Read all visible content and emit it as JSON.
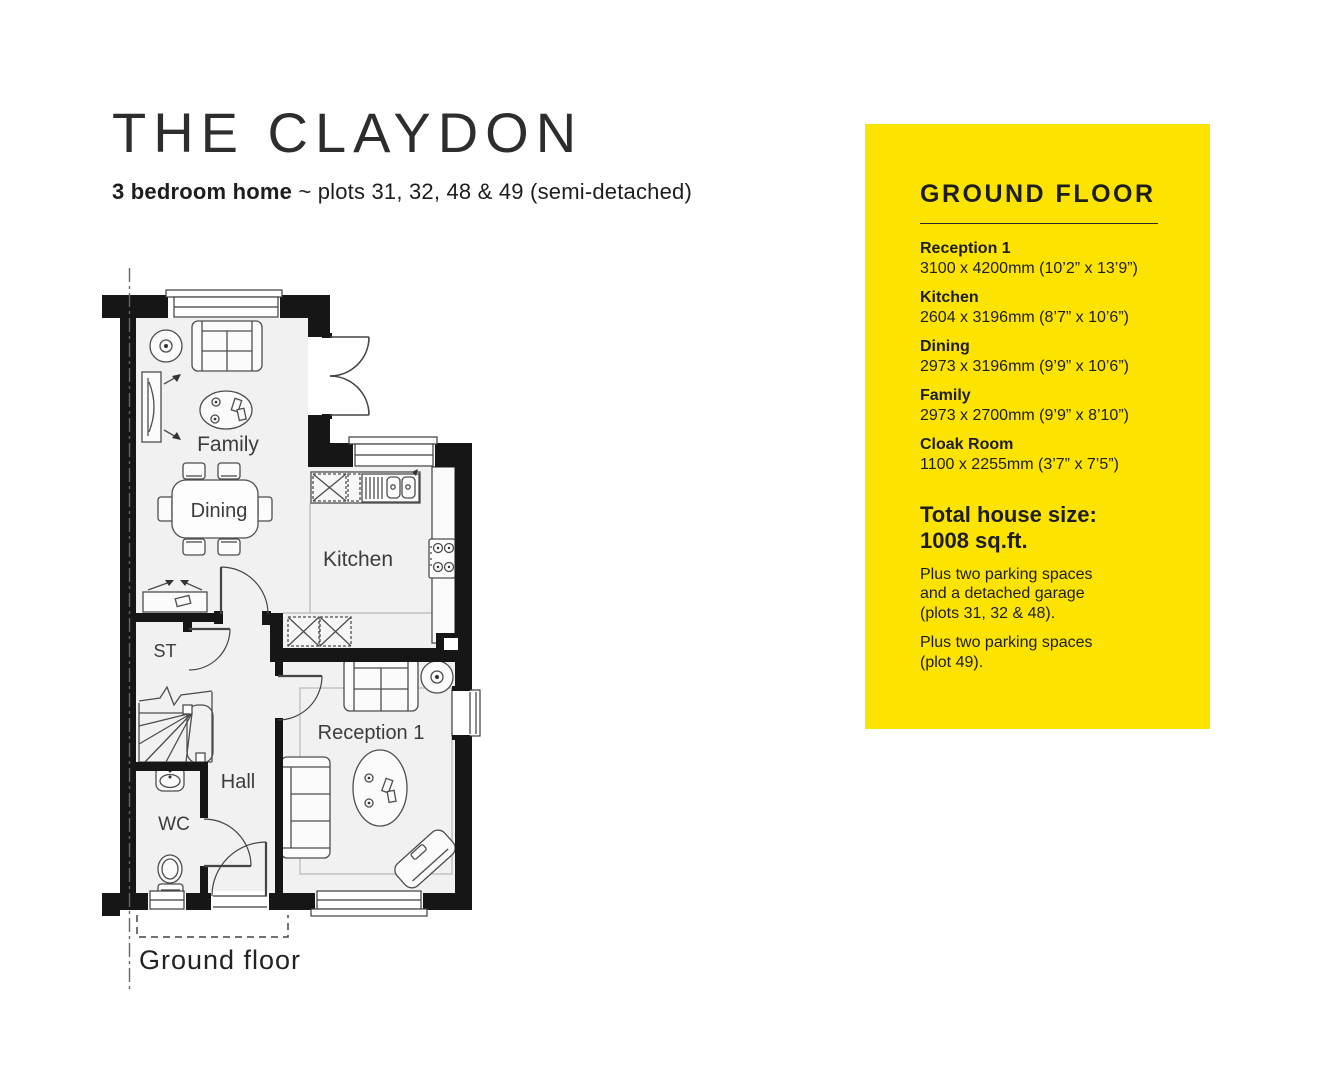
{
  "page": {
    "title": "THE CLAYDON",
    "subtitle_bold": "3 bedroom home",
    "subtitle_rest": " ~ plots 31, 32, 48 & 49 (semi-detached)"
  },
  "floorplan": {
    "labels": {
      "family": "Family",
      "dining": "Dining",
      "kitchen": "Kitchen",
      "st": "ST",
      "hall": "Hall",
      "wc": "WC",
      "reception": "Reception 1"
    },
    "caption": "Ground floor"
  },
  "panel": {
    "heading": "GROUND FLOOR",
    "bg_style": "background:#FCE400",
    "bg_color": "#FCE400",
    "text_color": "#1D1D1B",
    "rooms": [
      {
        "name": "Reception 1",
        "dims": "3100 x 4200mm (10’2” x 13’9”)"
      },
      {
        "name": "Kitchen",
        "dims": "2604 x 3196mm (8’7” x 10’6”)"
      },
      {
        "name": "Dining",
        "dims": "2973 x 3196mm (9’9” x 10’6”)"
      },
      {
        "name": "Family",
        "dims": "2973 x 2700mm (9’9” x 8’10”)"
      },
      {
        "name": "Cloak Room",
        "dims": "1100 x 2255mm (3’7” x 7’5”)"
      }
    ],
    "total_line1": "Total house size:",
    "total_line2": "1008 sq.ft.",
    "note1": "Plus two parking spaces and a detached garage (plots 31, 32 & 48).",
    "note2": "Plus two parking spaces (plot 49)."
  }
}
